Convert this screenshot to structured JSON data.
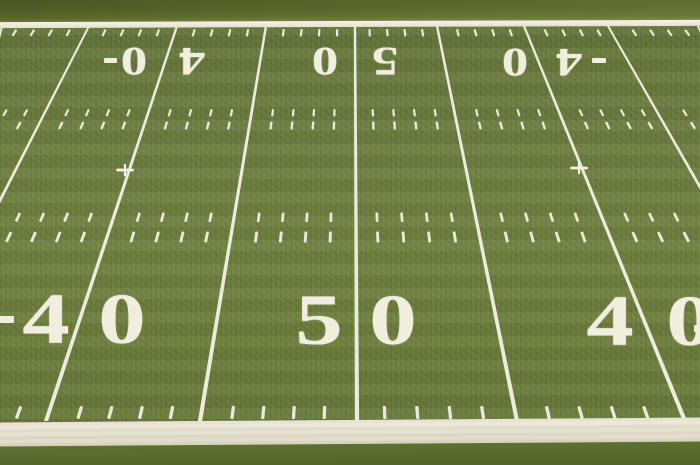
{
  "scene": {
    "subject": "American football field artificial turf viewed from an elevated angle",
    "visible_span": "midfield, 40 - 50 - 40 yard lines with hash marks and sidelines"
  },
  "yard_numbers": {
    "far_row": [
      {
        "label": "40",
        "digits": [
          "4",
          "0"
        ],
        "orientation": "upside-down",
        "goal_arrow": "toward-left-goal"
      },
      {
        "label": "50",
        "digits": [
          "5",
          "0"
        ],
        "orientation": "upside-down"
      },
      {
        "label": "40",
        "digits": [
          "4",
          "0"
        ],
        "orientation": "upside-down",
        "goal_arrow": "toward-right-goal"
      }
    ],
    "near_row": [
      {
        "label": "40",
        "digits": [
          "4",
          "0"
        ],
        "orientation": "upright",
        "goal_arrow": "toward-left-goal"
      },
      {
        "label": "50",
        "digits": [
          "5",
          "0"
        ],
        "orientation": "upright"
      },
      {
        "label": "40",
        "digits": [
          "4",
          "0"
        ],
        "orientation": "upright",
        "goal_arrow": "toward-right-goal"
      }
    ]
  },
  "colors": {
    "grass": "#6b7d3c",
    "line_white": "#f2efe3",
    "sideline_band": "#e3decc",
    "far_apron": "#55642b",
    "near_apron": "#5c6e31"
  }
}
